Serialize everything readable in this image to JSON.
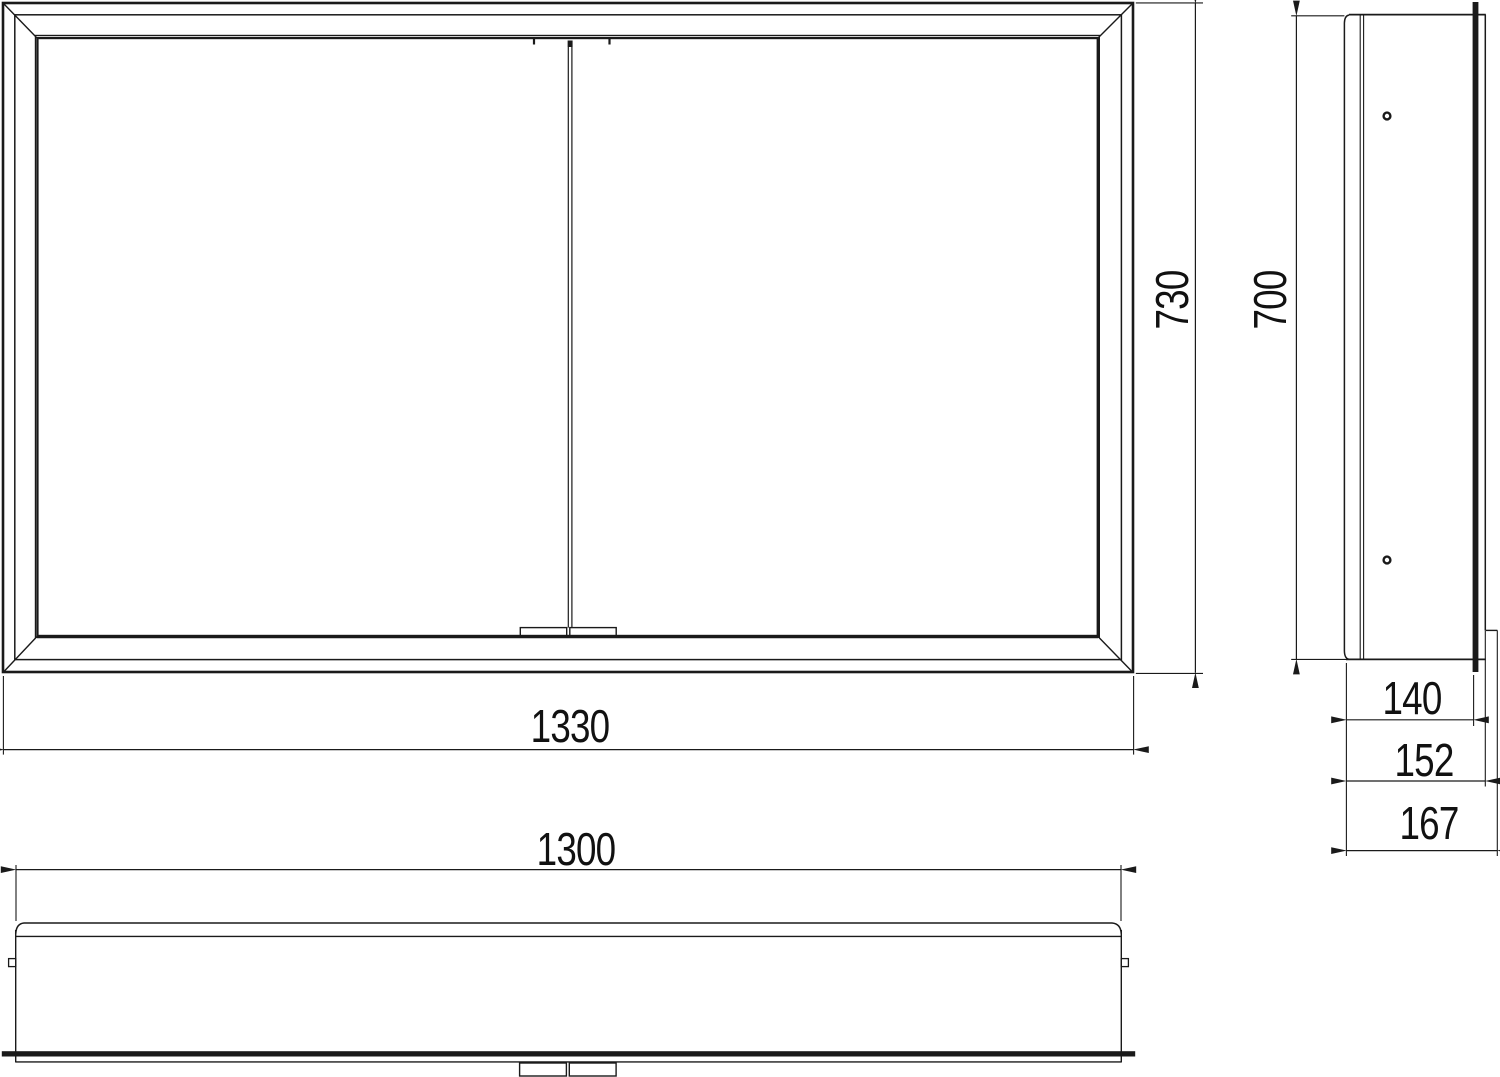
{
  "page": {
    "background": "#ffffff",
    "line_color": "#1a1a1a"
  },
  "dims": {
    "front_width": "1330",
    "front_height": "730",
    "side_height": "700",
    "depth_body": "140",
    "depth_frame": "152",
    "depth_overall": "167",
    "carcass_width": "1300"
  }
}
